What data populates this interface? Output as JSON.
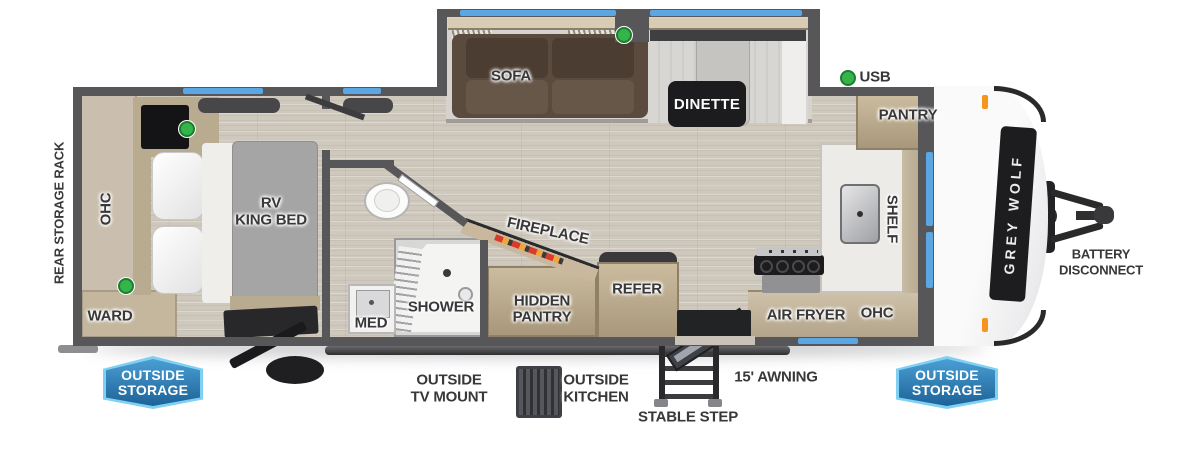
{
  "title": "Grey Wolf travel trailer floor plan",
  "brand": {
    "logo": "GREY WOLF"
  },
  "exterior_labels": {
    "rear_storage_rack": "REAR STORAGE RACK",
    "usb": "USB",
    "battery_line1": "BATTERY",
    "battery_line2": "DISCONNECT",
    "outside_storage_line1": "OUTSIDE",
    "outside_storage_line2": "STORAGE",
    "outside_tv_line1": "OUTSIDE",
    "outside_tv_line2": "TV MOUNT",
    "outside_kitchen_line1": "OUTSIDE",
    "outside_kitchen_line2": "KITCHEN",
    "stable_step": "STABLE STEP",
    "awning": "15' AWNING"
  },
  "room_labels": {
    "sofa": "SOFA",
    "dinette": "DINETTE",
    "pantry": "PANTRY",
    "shelf": "SHELF",
    "ohc_bedroom": "OHC",
    "ohc_kitchen": "OHC",
    "ward": "WARD",
    "bed_line1": "RV",
    "bed_line2": "KING BED",
    "med": "MED",
    "shower": "SHOWER",
    "fireplace": "FIREPLACE",
    "hidden_pantry_line1": "HIDDEN",
    "hidden_pantry_line2": "PANTRY",
    "refer": "REFER",
    "air_fryer": "AIR FRYER"
  },
  "colors": {
    "wall_gray": "#57575a",
    "window_blue": "#5ba7e3",
    "badge_blue": "#1d6298",
    "badge_border_blue": "#7fd0f2",
    "led_green": "#35b44a",
    "marker_orange": "#f7941d"
  }
}
